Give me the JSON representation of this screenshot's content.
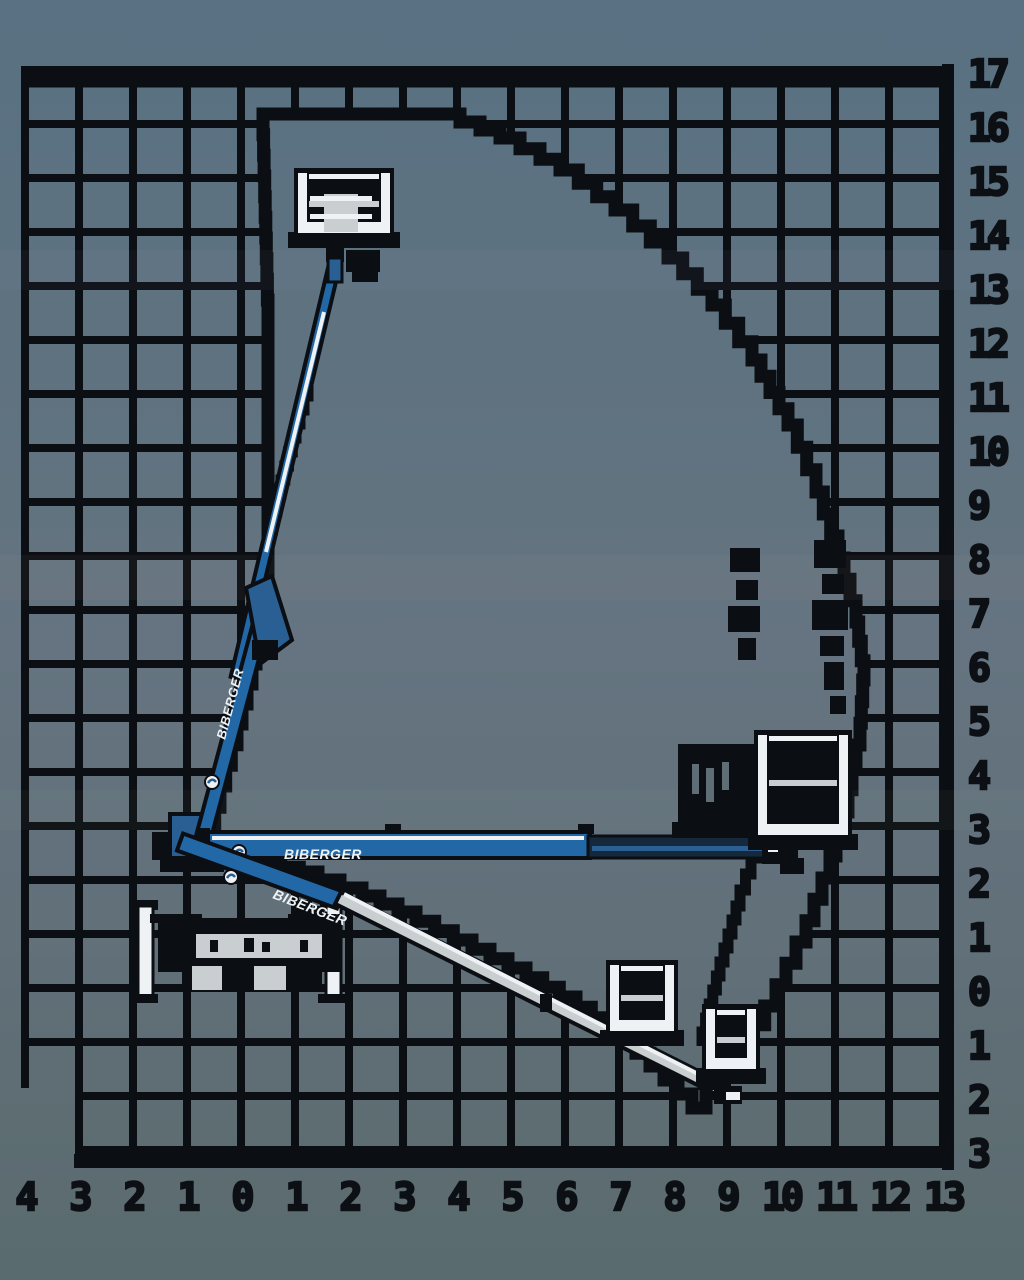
{
  "brand": "BIBERGER",
  "colors": {
    "ink": "#0b0e12",
    "boom_blue": "#2368a6",
    "boom_blue_dark": "#16293c",
    "boom_blue_mid": "#2a5f93",
    "rail_white": "#eef2f4",
    "pale_grey": "#c9ced0",
    "slit_grey": "#5f6d76",
    "bg_top": "#597183",
    "bg_mid": "#657480",
    "bg_bottom": "#5a6b70"
  },
  "chart_data": {
    "type": "area",
    "title": "BIBERGER articulated boom lift working range envelope",
    "x_axis": {
      "labels": [
        "4",
        "3",
        "2",
        "1",
        "0",
        "1",
        "2",
        "3",
        "4",
        "5",
        "6",
        "7",
        "8",
        "9",
        "10",
        "11",
        "12",
        "13"
      ],
      "range_m": [
        -4,
        13
      ]
    },
    "y_axis": {
      "labels": [
        "17",
        "16",
        "15",
        "14",
        "13",
        "12",
        "11",
        "10",
        "9",
        "8",
        "7",
        "6",
        "5",
        "4",
        "3",
        "2",
        "1",
        "0",
        "1",
        "2",
        "3"
      ],
      "range_m": [
        -3,
        17
      ]
    },
    "envelope_m": [
      [
        0.4,
        16.2
      ],
      [
        3.7,
        16.2
      ],
      [
        4.8,
        15.7
      ],
      [
        5.9,
        15.1
      ],
      [
        6.9,
        14.4
      ],
      [
        7.9,
        13.5
      ],
      [
        8.7,
        12.6
      ],
      [
        9.5,
        11.6
      ],
      [
        10.1,
        10.4
      ],
      [
        10.6,
        9.2
      ],
      [
        11.1,
        8.0
      ],
      [
        11.4,
        6.8
      ],
      [
        11.5,
        5.7
      ],
      [
        11.5,
        4.5
      ],
      [
        11.2,
        3.3
      ],
      [
        10.9,
        2.0
      ],
      [
        10.5,
        0.9
      ],
      [
        9.9,
        -0.3
      ],
      [
        9.3,
        -1.4
      ],
      [
        8.6,
        -2.2
      ],
      [
        7.8,
        -1.4
      ],
      [
        7.1,
        -0.7
      ],
      [
        6.2,
        -0.2
      ],
      [
        5.3,
        0.4
      ],
      [
        4.3,
        0.9
      ],
      [
        3.2,
        1.4
      ],
      [
        2.2,
        1.9
      ],
      [
        1.4,
        2.1
      ],
      [
        0.4,
        2.4
      ],
      [
        -0.7,
        2.6
      ],
      [
        -0.4,
        3.7
      ],
      [
        -0.1,
        4.9
      ],
      [
        0.2,
        6.0
      ],
      [
        0.4,
        7.0
      ],
      [
        0.5,
        7.9
      ],
      [
        0.5,
        12.7
      ]
    ],
    "grid": true,
    "legend": "none"
  },
  "geometry": {
    "px_per_m": 54,
    "origin_px": {
      "x": 241,
      "y": 988
    },
    "grid": {
      "x0": 25,
      "y0": 70,
      "cols": 17,
      "rows": 20,
      "step": 54
    },
    "envelope_px": [
      [
        263,
        114
      ],
      [
        440,
        114
      ],
      [
        500,
        138
      ],
      [
        560,
        170
      ],
      [
        615,
        210
      ],
      [
        668,
        258
      ],
      [
        712,
        305
      ],
      [
        752,
        360
      ],
      [
        788,
        425
      ],
      [
        816,
        492
      ],
      [
        838,
        558
      ],
      [
        856,
        622
      ],
      [
        864,
        680
      ],
      [
        860,
        745
      ],
      [
        848,
        812
      ],
      [
        830,
        878
      ],
      [
        806,
        942
      ],
      [
        776,
        1006
      ],
      [
        742,
        1062
      ],
      [
        706,
        1108
      ],
      [
        664,
        1066
      ],
      [
        622,
        1028
      ],
      [
        576,
        997
      ],
      [
        526,
        968
      ],
      [
        472,
        940
      ],
      [
        416,
        912
      ],
      [
        362,
        888
      ],
      [
        318,
        872
      ],
      [
        262,
        858
      ],
      [
        204,
        850
      ],
      [
        220,
        786
      ],
      [
        237,
        724
      ],
      [
        252,
        664
      ],
      [
        264,
        610
      ],
      [
        268,
        560
      ],
      [
        268,
        300
      ],
      [
        263,
        114
      ]
    ],
    "inner_steps": [
      [
        [
          312,
          382
        ],
        [
          296,
          438
        ],
        [
          281,
          494
        ],
        [
          268,
          548
        ]
      ],
      [
        [
          762,
          842
        ],
        [
          740,
          906
        ],
        [
          720,
          976
        ],
        [
          702,
          1046
        ]
      ]
    ],
    "booms": [
      {
        "name": "upper-telescopic-boom",
        "x1": 336,
        "y1": 258,
        "x2": 236,
        "y2": 678,
        "w": 11,
        "style": "blue",
        "stripe": [
          324,
          312,
          266,
          552
        ]
      },
      {
        "name": "lower-riser-boom",
        "x1": 200,
        "y1": 850,
        "x2": 268,
        "y2": 596,
        "w": 15,
        "style": "blue",
        "label": true,
        "label_at": [
          225,
          740
        ],
        "label_angle": -75,
        "label_size": 13,
        "logo_at": [
          212,
          782
        ]
      },
      {
        "name": "outreach-boom",
        "x1": 206,
        "y1": 845,
        "x2": 590,
        "y2": 845,
        "w": 26,
        "style": "blue-horizontal",
        "label": true,
        "label_at": [
          284,
          859
        ],
        "label_angle": 0,
        "label_size": 14,
        "logo_at": [
          239,
          852
        ]
      },
      {
        "name": "transport-boom",
        "x1": 180,
        "y1": 842,
        "x2": 340,
        "y2": 900,
        "w": 18,
        "style": "blue",
        "label": true,
        "label_at": [
          272,
          898
        ],
        "label_angle": 21,
        "label_size": 14,
        "logo_at": [
          231,
          877
        ]
      },
      {
        "name": "lowering-telescopic-boom",
        "x1": 338,
        "y1": 898,
        "x2": 722,
        "y2": 1090,
        "w": 13,
        "style": "grey",
        "stripe": [
          344,
          894,
          714,
          1082
        ]
      }
    ],
    "baskets": [
      {
        "name": "basket-max-height",
        "x": 294,
        "y": 168,
        "w": 100,
        "h": 78,
        "variant": "light",
        "seat": true
      },
      {
        "name": "basket-outreach-shadow",
        "x": 678,
        "y": 744,
        "w": 76,
        "h": 92,
        "variant": "dark"
      },
      {
        "name": "basket-max-outreach",
        "x": 754,
        "y": 730,
        "w": 98,
        "h": 118,
        "variant": "light"
      },
      {
        "name": "basket-below-grade-mid",
        "x": 606,
        "y": 960,
        "w": 72,
        "h": 84,
        "variant": "light"
      },
      {
        "name": "basket-below-grade-tip",
        "x": 702,
        "y": 1004,
        "w": 58,
        "h": 78,
        "variant": "light"
      }
    ],
    "dimension_marks": [
      [
        730,
        548,
        30,
        24
      ],
      [
        736,
        580,
        22,
        20
      ],
      [
        728,
        606,
        32,
        26
      ],
      [
        738,
        638,
        18,
        22
      ],
      [
        814,
        540,
        32,
        28
      ],
      [
        822,
        574,
        22,
        20
      ],
      [
        812,
        600,
        36,
        30
      ],
      [
        820,
        636,
        24,
        20
      ],
      [
        824,
        662,
        20,
        28
      ],
      [
        830,
        696,
        16,
        18
      ]
    ]
  }
}
